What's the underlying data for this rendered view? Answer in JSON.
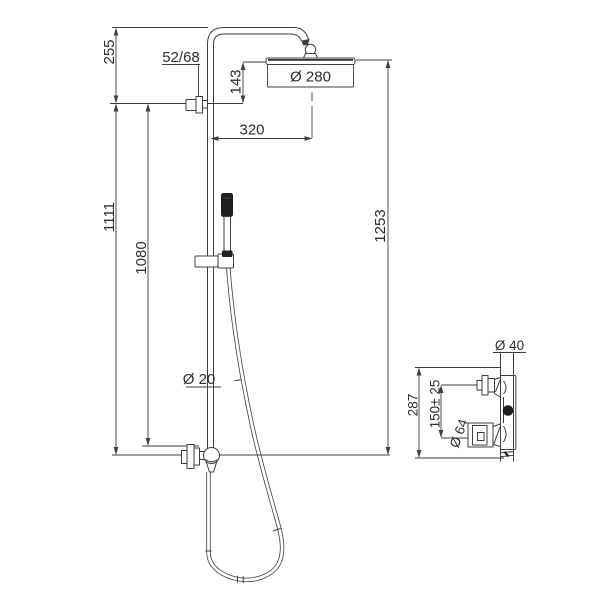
{
  "page": {
    "background_color": "#ffffff"
  },
  "drawing": {
    "colors": {
      "line": "#3f3f3f",
      "text": "#2e2e2e",
      "dark_fill": "#1f1f1f"
    },
    "main_view": {
      "labels": {
        "offset_top": "255",
        "wall_escutcheon": "52/68",
        "head_to_wall": "143",
        "head_diameter": "Ø 280",
        "arm_reach": "320",
        "riser_upper": "1111",
        "riser_lower": "1080",
        "overall_height": "1253",
        "pipe_diameter": "Ø 20"
      }
    },
    "valve_view": {
      "labels": {
        "connection_diameter": "Ø 40",
        "valve_height": "287",
        "inlet_spacing": "150± 25",
        "escutcheon_diameter": "Ø 64"
      }
    }
  }
}
